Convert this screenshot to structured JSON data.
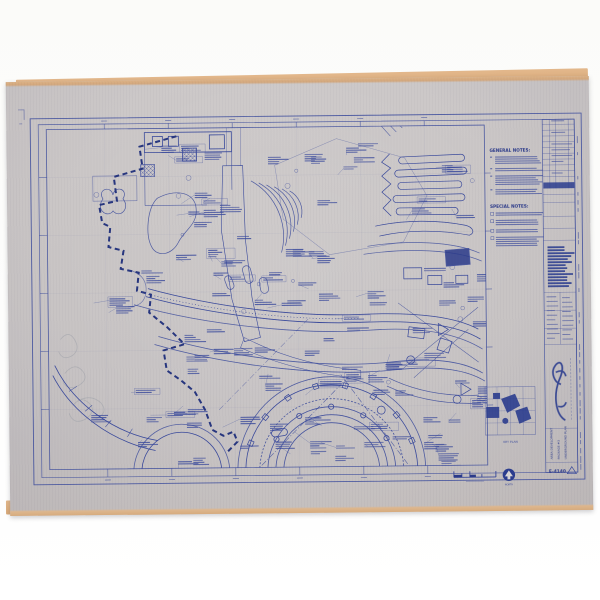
{
  "photo": {
    "background_color": "#fbfbf9"
  },
  "sheet": {
    "paper_color": "#c9c5c5",
    "edge_color": "#d9b287",
    "ink_color": "#3a4a9c",
    "ink_dark_color": "#2b3a8a",
    "ink_light_color": "#8791c4"
  },
  "notes": {
    "general_title": "GENERAL NOTES:",
    "special_title": "SPECIAL NOTES:"
  },
  "legend": {
    "key_plan_label": "KEY PLAN",
    "north_label": "NORTH"
  },
  "title_block": {
    "title_lines": [
      "AREA DEVELOPMENT",
      "PACKAGE #3",
      "UNDERGROUND PLAN"
    ],
    "sheet_number": "E-4140"
  }
}
